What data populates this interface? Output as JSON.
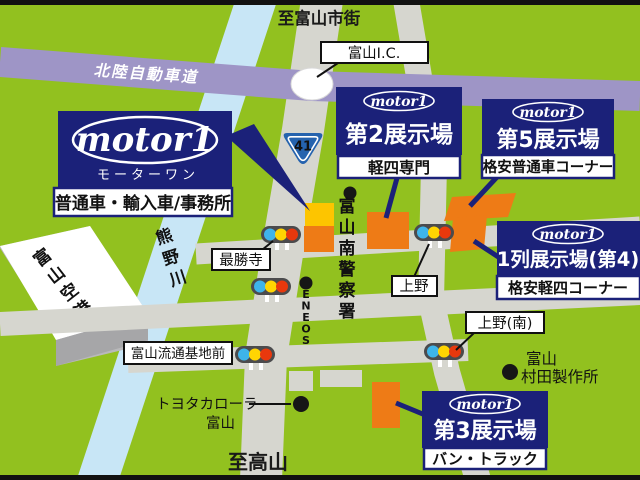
{
  "colors": {
    "background": "#92c11f",
    "road": "#d6d6cf",
    "expressway": "#9e95c6",
    "river": "#c8e6f6",
    "navy": "#1b2179",
    "lot_orange": "#ee7b16",
    "lot_yellow": "#fdc500",
    "signal_housing": "#4b4b4d",
    "signal_blue": "#3eb4ea",
    "signal_yellow": "#ffd502",
    "signal_red": "#e8380d",
    "route_sign_blue": "#2563ae",
    "letterbox": "#111111"
  },
  "header": {
    "to_toyama_city": "至富山市街"
  },
  "footer": {
    "to_takayama": "至高山"
  },
  "expressway": {
    "name": "北陸自動車道",
    "interchange": "富山I.C."
  },
  "route": {
    "number": "41"
  },
  "places": {
    "airport": "富山空港",
    "river": "熊野川",
    "temple": "最勝寺",
    "police": "富山南警察署",
    "gas_station": "ENEOS",
    "ueno": "上野",
    "ueno_south": "上野(南)",
    "distribution_base": "富山流通基地前",
    "toyota_corolla_line1": "トヨタカローラ",
    "toyota_corolla_line2": "富山",
    "murata_line1": "富山",
    "murata_line2": "村田製作所"
  },
  "signs": {
    "main": {
      "logo": "motor1",
      "kana": "モーターワン",
      "subtitle": "普通車・輸入車/事務所"
    },
    "site2": {
      "logo": "motor1",
      "title": "第2展示場",
      "subtitle": "軽四専門"
    },
    "site5": {
      "logo": "motor1",
      "title": "第5展示場",
      "subtitle": "格安普通車コーナー"
    },
    "site4": {
      "logo": "motor1",
      "title": "1列展示場(第4)",
      "subtitle": "格安軽四コーナー"
    },
    "site3": {
      "logo": "motor1",
      "title": "第3展示場",
      "subtitle": "バン・トラック"
    }
  }
}
